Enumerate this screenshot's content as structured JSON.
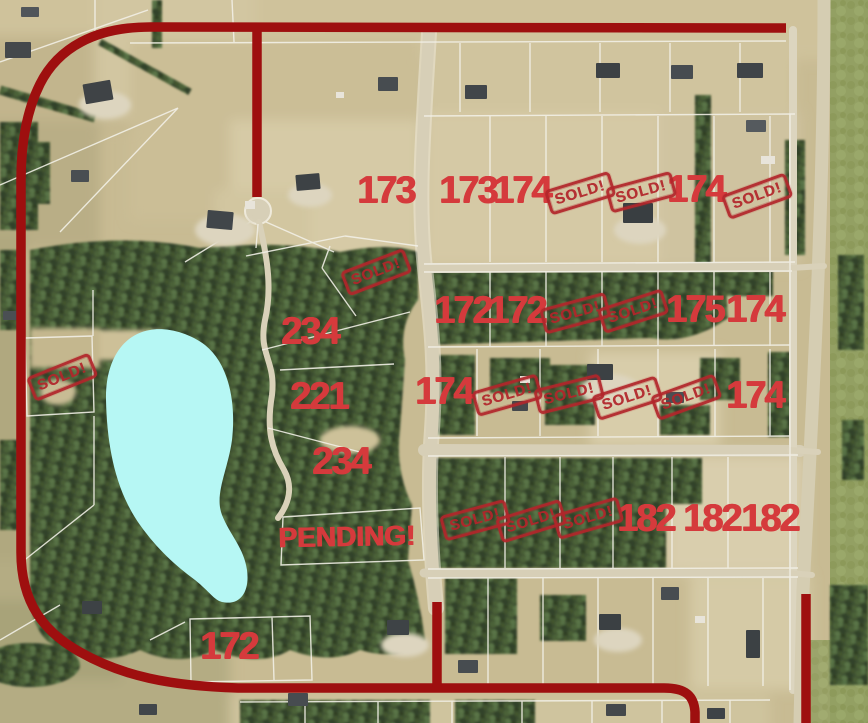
{
  "map": {
    "description": "Aerial acreage lot map with prices and sale status overlays",
    "colors": {
      "label_red": "#d53a3c",
      "stamp_red": "#b2262b",
      "road_red": "#9e0f0f",
      "lake_cyan": "#b6f7f4",
      "forest_green": "#3e5030",
      "field_tan": "#c8bb93"
    }
  },
  "lots": {
    "sold_label": "SOLD!",
    "pending": {
      "text": "PENDING!",
      "x": 347,
      "y": 537
    },
    "price_labels": [
      {
        "text": "173",
        "x": 386,
        "y": 191
      },
      {
        "text": "173",
        "x": 468,
        "y": 191
      },
      {
        "text": "174",
        "x": 522,
        "y": 191
      },
      {
        "text": "174",
        "x": 696,
        "y": 190
      },
      {
        "text": "172",
        "x": 463,
        "y": 311
      },
      {
        "text": "172",
        "x": 517,
        "y": 311
      },
      {
        "text": "175",
        "x": 695,
        "y": 310
      },
      {
        "text": "174",
        "x": 755,
        "y": 310
      },
      {
        "text": "174",
        "x": 444,
        "y": 392
      },
      {
        "text": "174",
        "x": 755,
        "y": 396
      },
      {
        "text": "182",
        "x": 646,
        "y": 519
      },
      {
        "text": "182",
        "x": 712,
        "y": 519
      },
      {
        "text": "182",
        "x": 770,
        "y": 519
      },
      {
        "text": "234",
        "x": 310,
        "y": 332
      },
      {
        "text": "221",
        "x": 319,
        "y": 397
      },
      {
        "text": "234",
        "x": 341,
        "y": 462
      },
      {
        "text": "172",
        "x": 229,
        "y": 647
      }
    ],
    "sold_stamps": [
      {
        "x": 580,
        "y": 193,
        "rot": -17
      },
      {
        "x": 641,
        "y": 192,
        "rot": -15
      },
      {
        "x": 757,
        "y": 196,
        "rot": -20
      },
      {
        "x": 376,
        "y": 272,
        "rot": -21
      },
      {
        "x": 62,
        "y": 377,
        "rot": -22
      },
      {
        "x": 575,
        "y": 313,
        "rot": -15
      },
      {
        "x": 633,
        "y": 311,
        "rot": -18
      },
      {
        "x": 507,
        "y": 395,
        "rot": -16
      },
      {
        "x": 569,
        "y": 394,
        "rot": -14
      },
      {
        "x": 627,
        "y": 398,
        "rot": -18
      },
      {
        "x": 686,
        "y": 397,
        "rot": -20
      },
      {
        "x": 475,
        "y": 520,
        "rot": -15
      },
      {
        "x": 531,
        "y": 521,
        "rot": -17
      },
      {
        "x": 588,
        "y": 518,
        "rot": -16
      }
    ]
  }
}
